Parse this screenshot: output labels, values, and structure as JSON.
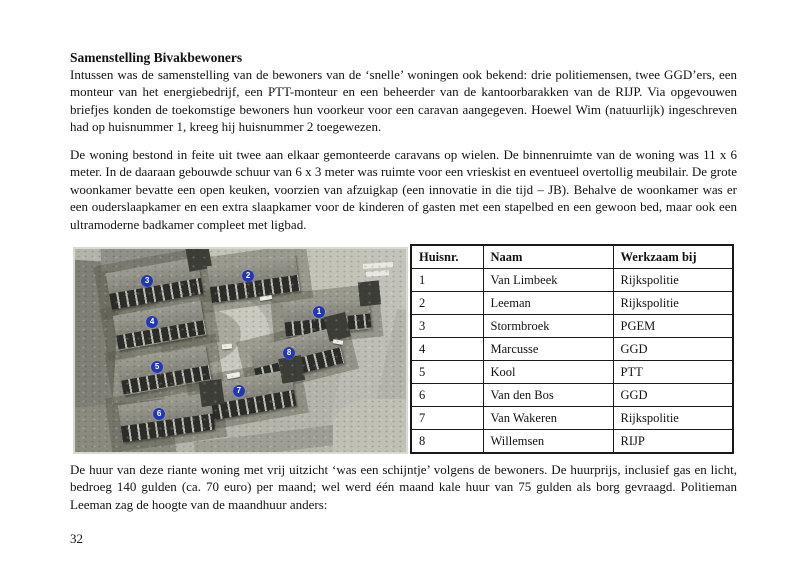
{
  "document": {
    "heading": "Samenstelling Bivakbewoners",
    "paragraph1": "Intussen was de samenstelling van de bewoners van de ‘snelle’ woningen ook bekend: drie politiemensen, twee GGD’ers, een monteur van het energiebedrijf, een PTT-monteur en een beheerder van de kantoorbarakken van de RIJP. Via opgevouwen briefjes konden de toekomstige bewoners hun voorkeur voor een caravan aangegeven. Hoewel Wim (natuurlijk) ingeschreven had op huisnummer 1, kreeg hij huisnummer 2 toegewezen.",
    "paragraph2": "De woning bestond in feite uit twee aan elkaar gemonteerde caravans op wielen. De binnenruimte van de woning was 11 x 6 meter. In de daaraan gebouwde schuur van 6 x 3 meter was ruimte voor een vrieskist en eventueel overtollig meubilair. De grote woonkamer bevatte een open keuken, voorzien van afzuigkap (een innovatie in die tijd – JB). Behalve de woonkamer was er een ouderslaapkamer en een extra slaapkamer voor de kinderen of gasten met een stapelbed en een gewoon bed, maar ook een ultramoderne badkamer compleet met ligbad.",
    "paragraph3": "De huur van deze riante woning met vrij uitzicht ‘was een schijntje’ volgens de bewoners. De huurprijs, inclusief gas en licht, bedroeg 140 gulden (ca. 70 euro) per maand; wel werd één maand kale huur van 75 gulden als borg gevraagd. Politieman Leeman zag de hoogte van de maandhuur anders:",
    "page_number": "32"
  },
  "table": {
    "headers": [
      "Huisnr.",
      "Naam",
      "Werkzaam bij"
    ],
    "col_widths": [
      72,
      130,
      120
    ],
    "rows": [
      [
        "1",
        "Van Limbeek",
        "Rijkspolitie"
      ],
      [
        "2",
        "Leeman",
        "Rijkspolitie"
      ],
      [
        "3",
        "Stormbroek",
        "PGEM"
      ],
      [
        "4",
        "Marcusse",
        "GGD"
      ],
      [
        "5",
        "Kool",
        "PTT"
      ],
      [
        "6",
        "Van den Bos",
        "GGD"
      ],
      [
        "7",
        "Van Wakeren",
        "Rijkspolitie"
      ],
      [
        "8",
        "Willemsen",
        "RIJP"
      ]
    ]
  },
  "photo": {
    "badge_color": "#2336b4",
    "markers": [
      {
        "label": "1",
        "x": 73.7,
        "y": 31.2
      },
      {
        "label": "2",
        "x": 52.3,
        "y": 13.4
      },
      {
        "label": "3",
        "x": 21.8,
        "y": 15.8
      },
      {
        "label": "4",
        "x": 23.3,
        "y": 36.1
      },
      {
        "label": "5",
        "x": 24.8,
        "y": 57.9
      },
      {
        "label": "6",
        "x": 25.4,
        "y": 81.2
      },
      {
        "label": "7",
        "x": 49.5,
        "y": 69.8
      },
      {
        "label": "8",
        "x": 64.7,
        "y": 51.0
      }
    ]
  }
}
